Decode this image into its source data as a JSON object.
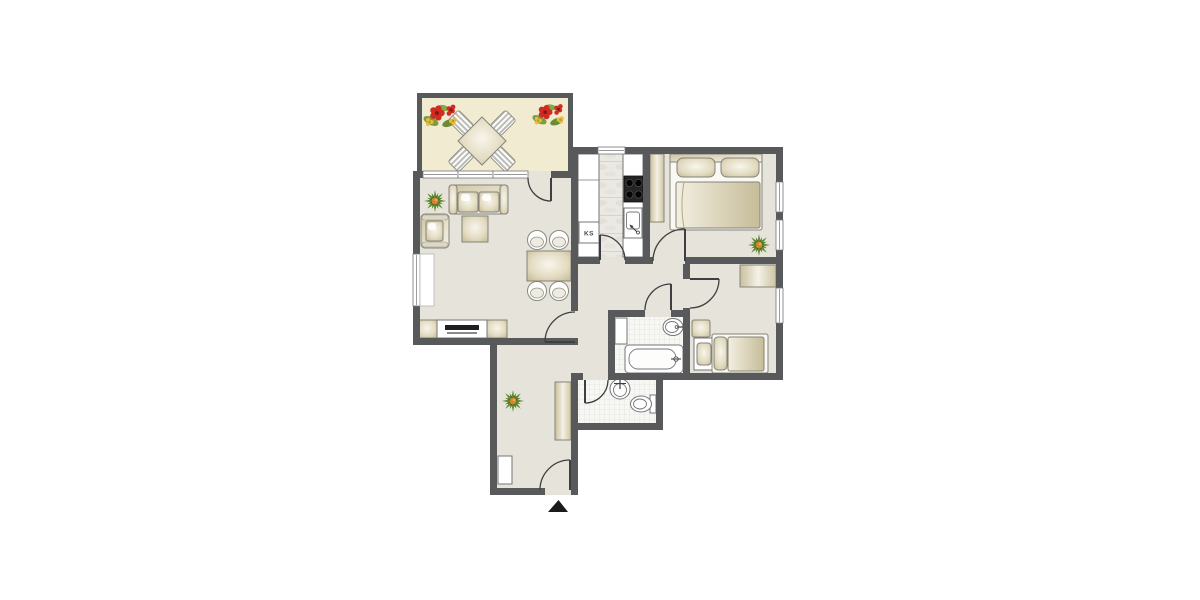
{
  "plan": {
    "type": "apartment-floor-plan",
    "labels": {
      "ks": "KS"
    },
    "entrance": {
      "marker": "arrow-up"
    },
    "colors": {
      "wall": "#58595b",
      "floor": "#e6e3da",
      "balcony_floor": "#f1ebd2",
      "furniture_beige": "#cfc5a3",
      "furniture_light": "#f6f3e9",
      "outline": "#84847a",
      "fixture_outline": "#76767a",
      "tile": "#f7f7f4",
      "tile_line": "#dddcd5",
      "door": "#3f3f41",
      "stove": "#1a1a1a",
      "plant_green": "#5f8f2f",
      "plant_dark": "#3f6a1e",
      "plant_center": "#d8832b",
      "flower_red": "#cf2b20",
      "flower_dark_red": "#8f1610",
      "flower_yellow": "#e7bd3a",
      "leaf_green": "#7d9c3e",
      "arrow": "#1b1b1b"
    },
    "rooms": [
      {
        "name": "balcony",
        "furniture": [
          "outdoor-dining-table",
          "outdoor-chair",
          "outdoor-chair",
          "outdoor-chair",
          "outdoor-chair",
          "flower-decoration",
          "flower-decoration"
        ]
      },
      {
        "name": "living-room",
        "furniture": [
          "sofa",
          "armchair",
          "coffee-table",
          "potted-plant",
          "dining-table",
          "dining-chair",
          "dining-chair",
          "dining-chair",
          "dining-chair",
          "tv-sideboard",
          "window"
        ]
      },
      {
        "name": "kitchen",
        "furniture": [
          "counter",
          "fridge",
          "stove",
          "sink",
          "window"
        ]
      },
      {
        "name": "bedroom-1",
        "furniture": [
          "wardrobe",
          "double-bed",
          "potted-plant",
          "window",
          "window"
        ]
      },
      {
        "name": "bedroom-2",
        "furniture": [
          "cabinet",
          "nightstand",
          "single-bed",
          "window"
        ]
      },
      {
        "name": "bathroom",
        "furniture": [
          "shelf",
          "washbasin",
          "bathtub"
        ]
      },
      {
        "name": "wc",
        "furniture": [
          "washbasin",
          "toilet"
        ]
      },
      {
        "name": "hallway",
        "furniture": [
          "wardrobe-cabinet",
          "potted-plant",
          "entrance-door"
        ]
      }
    ]
  }
}
